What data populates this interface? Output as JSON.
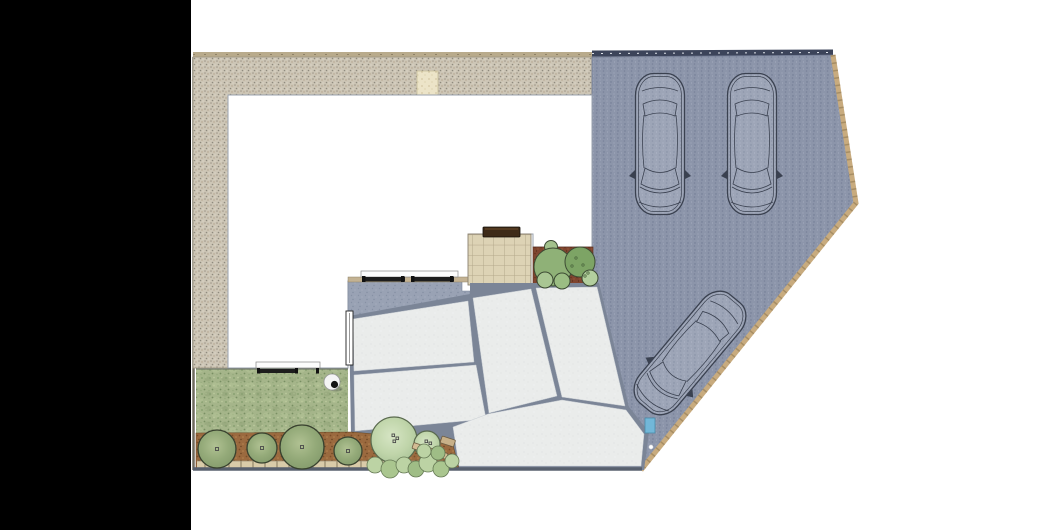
{
  "scene": {
    "type": "landscape-site-plan",
    "description": "Top-down residential garden plan: house footprint, gravel perimeter, block-paved driveway with two parked cars and one manoeuvring car, paved slab terrace and paths, tiled patio with bench, lawn, mulch planting beds with trees and shrubs"
  },
  "colors": {
    "background": "#ffffff",
    "black_panel": "#000000",
    "house_fill": "#ffffff",
    "house_outline": "#98a0ac",
    "gravel_base": "#cdc6b6",
    "driveway_base": "#8c95aa",
    "terrace_base": "#99a2b4",
    "slab_base": "#eaeceb",
    "joint_gray": "#7b8597",
    "lawn_base": "#a5b58a",
    "mulch_brown": "#9b6a3f",
    "mulch_red": "#7f452f",
    "patio_tile": "#ddd3b5",
    "bench_brown": "#3e2b18",
    "edging_tan": "#c8ab7e",
    "tree_green": "#95ab7a",
    "tree_pale": "#c4d9af",
    "shrub_green": "#8fb177",
    "marker_blue": "#72b7d8",
    "boundary_dark": "#58606e",
    "car_outline": "#3a4150",
    "gate_pad": "#ece4c8",
    "rail_dark": "#1d1d1d",
    "bed_strip_gray": "#ccd1d7",
    "edging_strip_tan": "#d9cba9"
  },
  "inventory": {
    "cars_parked": 2,
    "cars_maneuvering": 1,
    "row_trees": 6,
    "bed_shrubs": 6,
    "low_shrub_cluster": 9,
    "garden_spheres": 1,
    "benches": 1,
    "railings": 2,
    "doors": 1,
    "gate_pads": 1,
    "parking_markers": 1
  }
}
